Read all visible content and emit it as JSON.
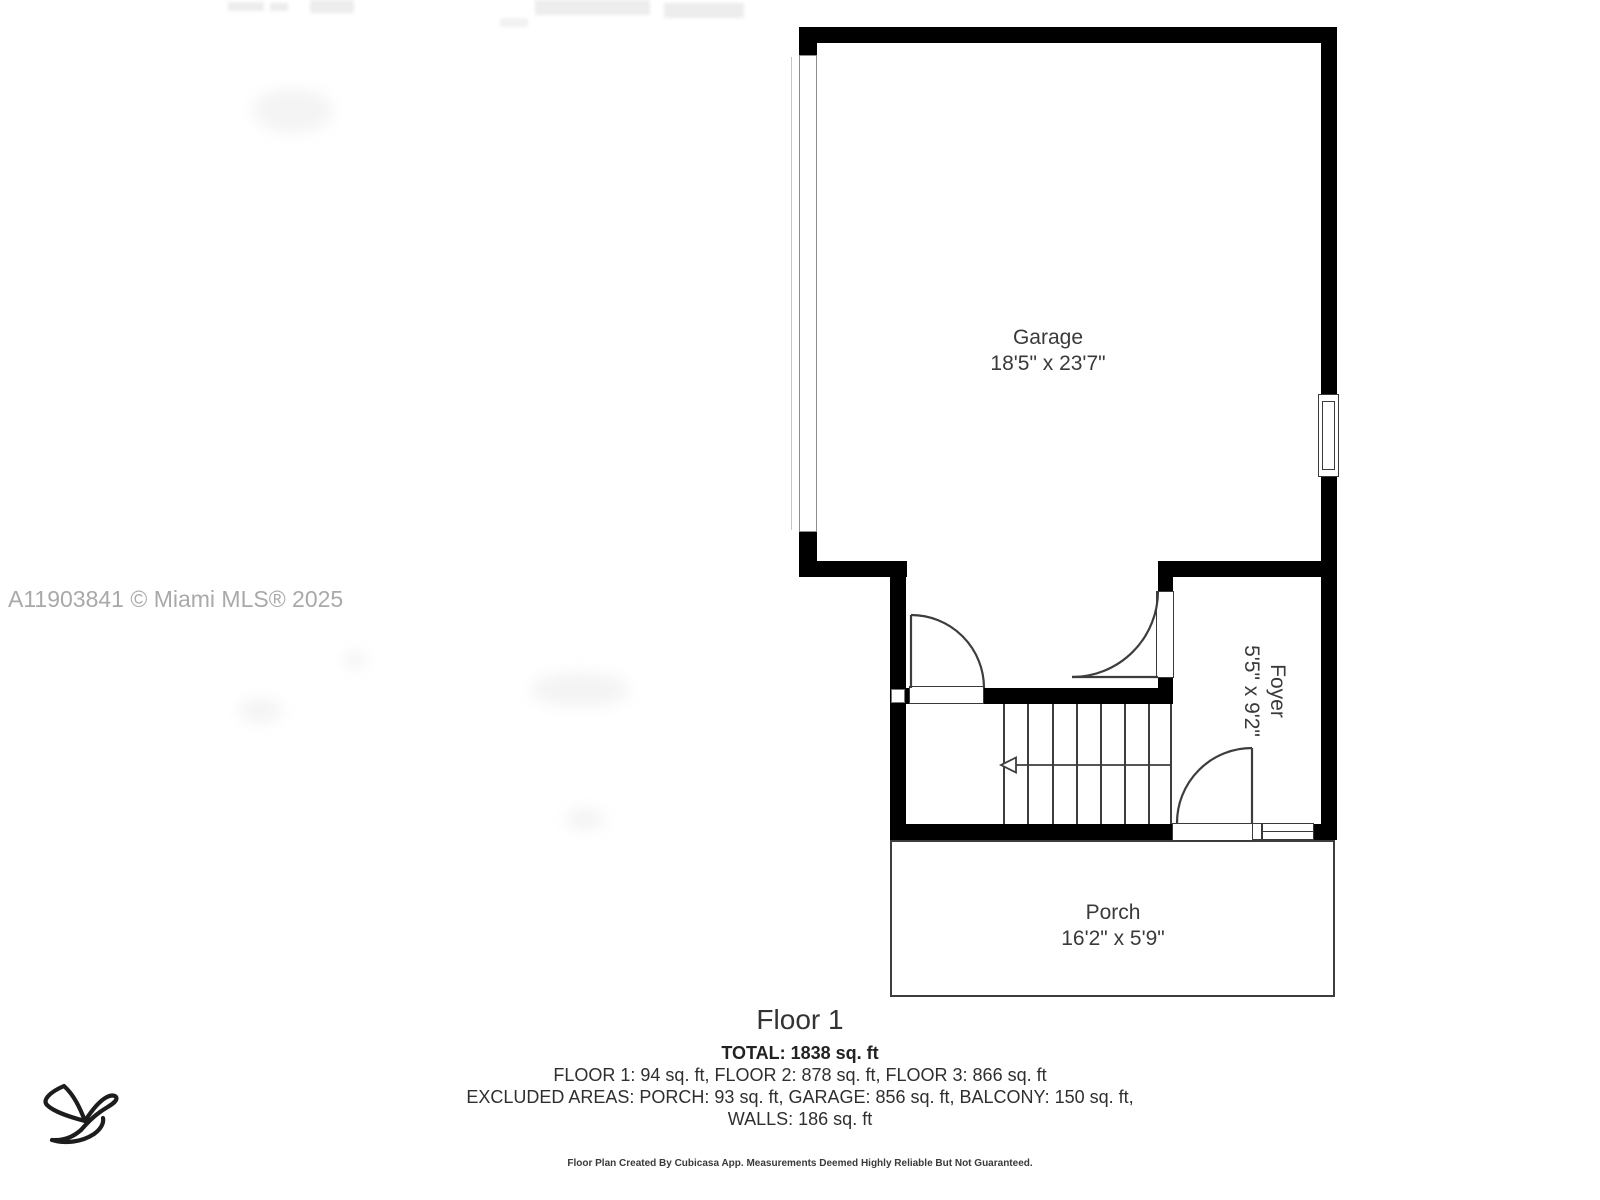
{
  "watermark": {
    "text": "A11903841 © Miami MLS® 2025"
  },
  "rooms": {
    "garage": {
      "name": "Garage",
      "dimensions": "18'5\" x 23'7\""
    },
    "foyer": {
      "name": "Foyer",
      "dimensions": "5'5\" x 9'2\""
    },
    "porch": {
      "name": "Porch",
      "dimensions": "16'2\" x 5'9\""
    }
  },
  "stairs": {
    "direction_arrow": "left"
  },
  "footer": {
    "floor_title": "Floor 1",
    "total": "TOTAL: 1838 sq. ft",
    "floor_breakdown": "FLOOR 1: 94 sq. ft, FLOOR 2: 878 sq. ft, FLOOR 3: 866 sq. ft",
    "excluded_areas": "EXCLUDED AREAS: PORCH: 93 sq. ft, GARAGE: 856 sq. ft, BALCONY: 150 sq. ft,",
    "walls": "WALLS: 186 sq. ft",
    "disclaimer": "Floor Plan Created By Cubicasa App. Measurements Deemed Highly Reliable But Not Guaranteed."
  },
  "logo": {
    "icon": "bird-logo"
  },
  "colors": {
    "wall": "#000000",
    "plan_line": "#3d3d3d",
    "label_text": "#3a3a3a",
    "watermark_text": "#a9a9a9"
  }
}
